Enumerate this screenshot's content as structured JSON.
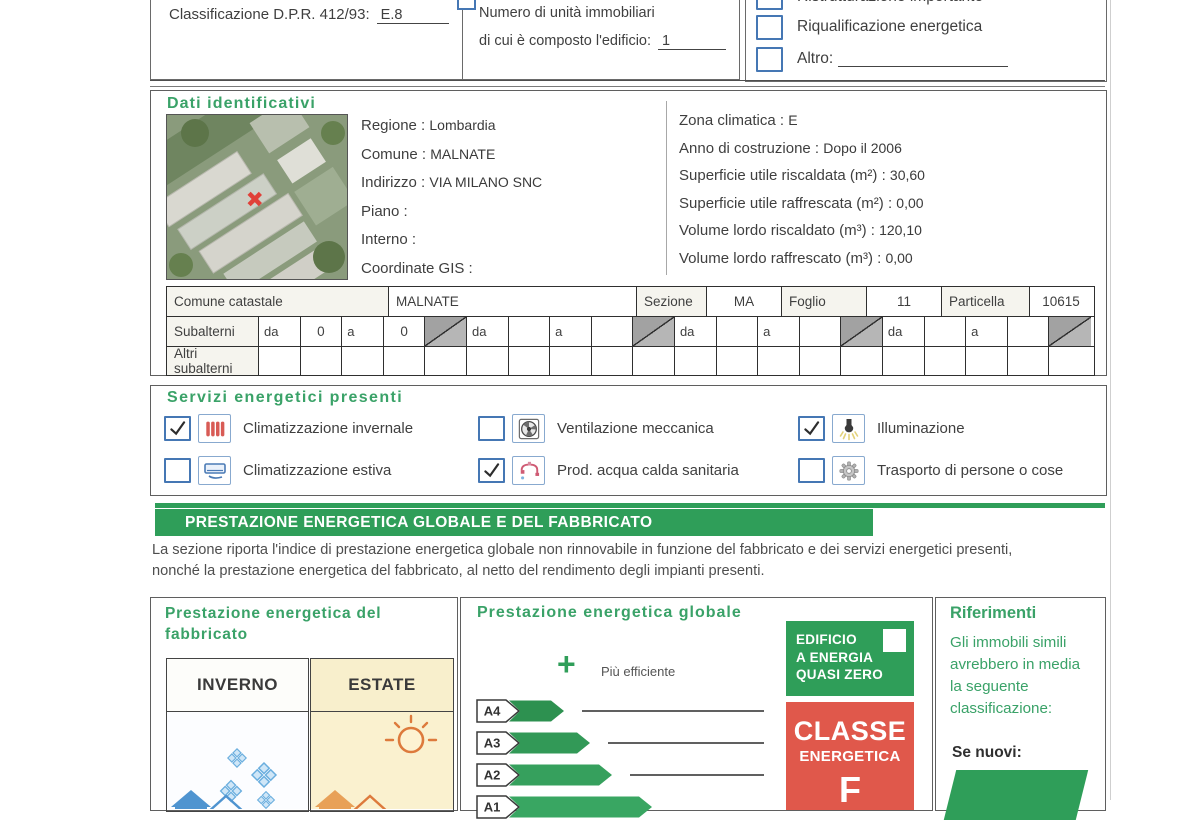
{
  "colors": {
    "accent_green": "#2f9e59",
    "heading_green": "#3aa268",
    "class_red": "#e0584b",
    "checkbox_blue": "#4577b4"
  },
  "top": {
    "classificazione_label": "Classificazione D.P.R. 412/93:",
    "classificazione_value": "E.8",
    "unita_line1": "Numero di unità immobiliari",
    "unita_line2": "di cui è composto l'edificio:",
    "unita_value": "1",
    "motivi": [
      {
        "label": "Ristrutturazione importante",
        "checked": false,
        "clipped": true,
        "underline": false
      },
      {
        "label": "Riqualificazione energetica",
        "checked": false,
        "clipped": false,
        "underline": false
      },
      {
        "label": "Altro:",
        "checked": false,
        "clipped": false,
        "underline": true
      }
    ]
  },
  "dati": {
    "title": "Dati identificativi",
    "left_fields": [
      {
        "label": "Regione",
        "value": "Lombardia"
      },
      {
        "label": "Comune",
        "value": "MALNATE"
      },
      {
        "label": "Indirizzo",
        "value": "VIA MILANO SNC"
      },
      {
        "label": "Piano",
        "value": ""
      },
      {
        "label": "Interno",
        "value": ""
      },
      {
        "label": "Coordinate GIS",
        "value": ""
      }
    ],
    "right_fields": [
      {
        "label": "Zona climatica",
        "value": "E"
      },
      {
        "label": "Anno di costruzione",
        "value": "Dopo il 2006"
      },
      {
        "label": "Superficie utile riscaldata (m²)",
        "value": "30,60"
      },
      {
        "label": "Superficie utile raffrescata (m²)",
        "value": "0,00"
      },
      {
        "label": "Volume lordo riscaldato (m³)",
        "value": "120,10"
      },
      {
        "label": "Volume lordo raffrescato (m³)",
        "value": "0,00"
      }
    ],
    "catasto": {
      "header": [
        {
          "text": "Comune catastale",
          "kind": "label",
          "align": "left"
        },
        {
          "text": "MALNATE",
          "kind": "value",
          "align": "left"
        },
        {
          "text": "Sezione",
          "kind": "label",
          "align": "center"
        },
        {
          "text": "MA",
          "kind": "value",
          "align": "center"
        },
        {
          "text": "Foglio",
          "kind": "label",
          "align": "center"
        },
        {
          "text": "11",
          "kind": "value",
          "align": "center"
        },
        {
          "text": "Particella",
          "kind": "label",
          "align": "center"
        },
        {
          "text": "10615",
          "kind": "value",
          "align": "center"
        }
      ],
      "subalterni_label": "Subalterni",
      "altri_label": "Altri subalterni",
      "da_label": "da",
      "a_label": "a",
      "groups": [
        {
          "da": "0",
          "a": "0"
        },
        {
          "da": "",
          "a": ""
        },
        {
          "da": "",
          "a": ""
        },
        {
          "da": "",
          "a": ""
        }
      ]
    }
  },
  "servizi": {
    "title": "Servizi energetici presenti",
    "items": [
      {
        "label": "Climatizzazione invernale",
        "checked": true,
        "icon": "radiator-icon"
      },
      {
        "label": "Climatizzazione estiva",
        "checked": false,
        "icon": "air-conditioner-icon"
      },
      {
        "label": "Ventilazione meccanica",
        "checked": false,
        "icon": "fan-icon"
      },
      {
        "label": "Prod. acqua calda sanitaria",
        "checked": true,
        "icon": "faucet-icon"
      },
      {
        "label": "Illuminazione",
        "checked": true,
        "icon": "light-bulb-icon"
      },
      {
        "label": "Trasporto di persone o cose",
        "checked": false,
        "icon": "gear-icon"
      }
    ]
  },
  "banner": {
    "title": "PRESTAZIONE ENERGETICA GLOBALE  E DEL FABBRICATO"
  },
  "intro": {
    "line1": "La sezione riporta l'indice di prestazione energetica globale non rinnovabile in funzione del fabbricato e dei servizi energetici presenti,",
    "line2": "nonché la prestazione energetica del fabbricato, al netto del rendimento degli impianti presenti."
  },
  "fabbricato": {
    "title1": "Prestazione energetica del",
    "title2": "fabbricato",
    "inverno_label": "INVERNO",
    "estate_label": "ESTATE"
  },
  "globale": {
    "title": "Prestazione energetica globale",
    "more_label": "Più efficiente",
    "classes": [
      {
        "label": "A4"
      },
      {
        "label": "A3"
      },
      {
        "label": "A2"
      },
      {
        "label": "A1"
      }
    ]
  },
  "nzeb": {
    "line1": "EDIFICIO",
    "line2": "A ENERGIA",
    "line3": "QUASI ZERO"
  },
  "classe": {
    "word1": "CLASSE",
    "word2": "ENERGETICA",
    "value": "F"
  },
  "riferimenti": {
    "title": "Riferimenti",
    "lines": [
      "Gli immobili simili",
      "avrebbero in media",
      "la seguente",
      "classificazione:"
    ],
    "se_nuovi": "Se nuovi:"
  }
}
